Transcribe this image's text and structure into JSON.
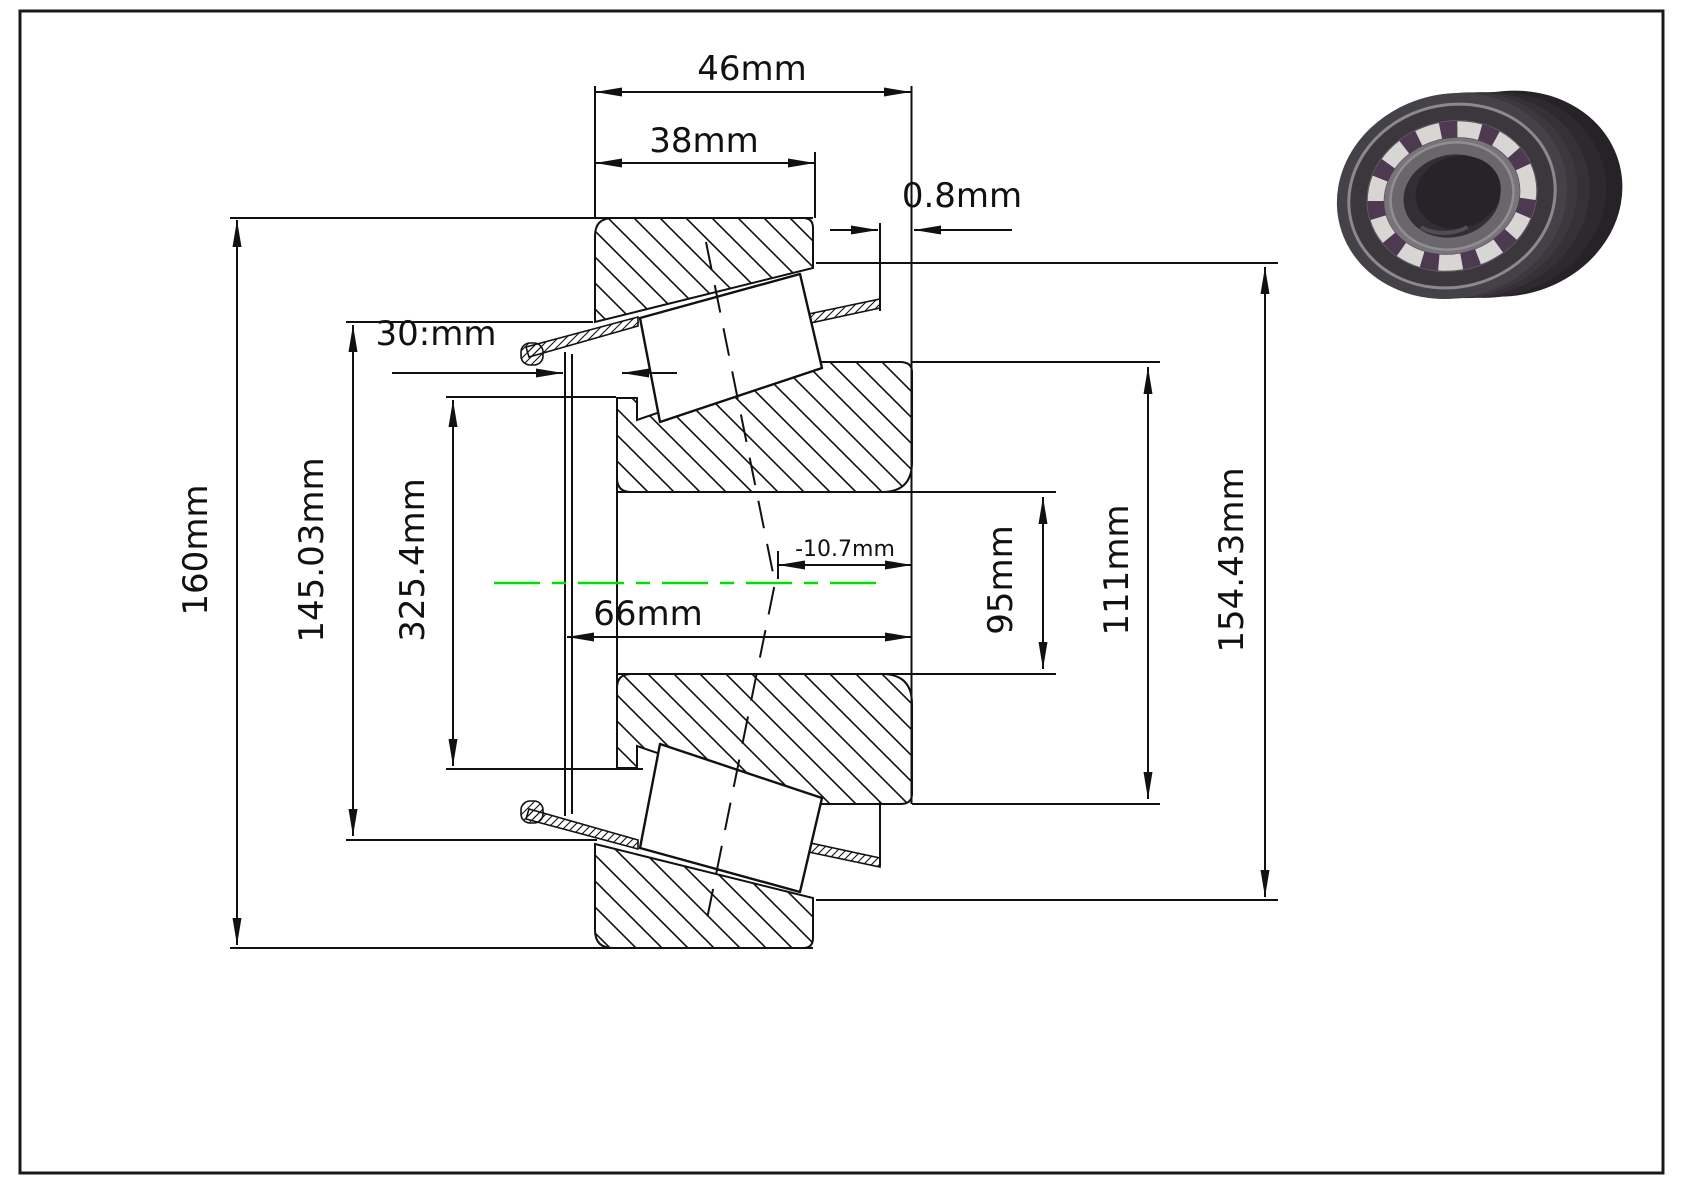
{
  "page": {
    "background": "#ffffff",
    "border_color": "#1a1a1a"
  },
  "drawing": {
    "type": "technical-engineering-drawing",
    "subject": "tapered roller bearing cross-section with dimensions",
    "line_color": "#111111",
    "centerline_color": "#00dd00",
    "dims": {
      "total_width": "46mm",
      "cup_width": "38mm",
      "protrusion": "0.8mm",
      "cage_width": "30:mm",
      "housing_od": "160mm",
      "flange_od": "145.03mm",
      "shoulder_od": "325.4mm",
      "effective_center": "-10.7mm",
      "cone_width": "66mm",
      "bore_diameter": "95mm",
      "rib_diameter": "111mm",
      "cup_back_diameter": "154.43mm"
    }
  },
  "thumbnail": {
    "description": "3d-render-of-roller-bearing",
    "ring_color": "#454148",
    "roller_color": "#d8d6d3",
    "bore_color": "#282329"
  }
}
